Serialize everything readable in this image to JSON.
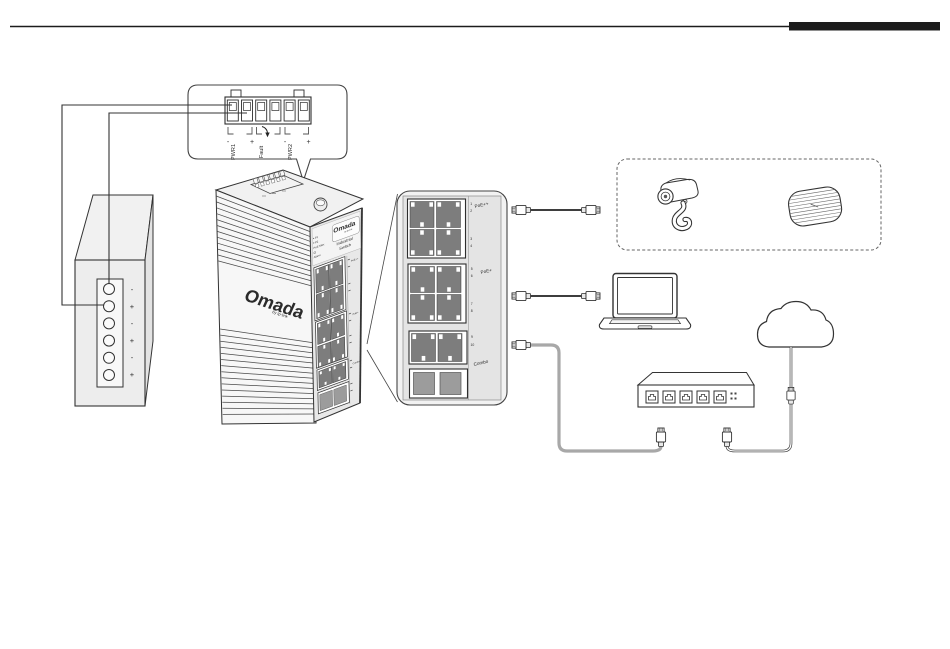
{
  "colors": {
    "line": "#2e2e2e",
    "panel_fill": "#efefef",
    "port_dark": "#7d7d7d",
    "sfp_gray": "#9c9c9c",
    "cable_gray": "#a8a8a8"
  },
  "terminal_callout": {
    "pwr1": "PWR1",
    "fault": "Fault",
    "pwr2": "PWR2",
    "minus": "-",
    "plus": "+"
  },
  "power_supply": {
    "terminals": [
      "-",
      "+",
      "-",
      "+",
      "-",
      "+"
    ]
  },
  "industrial_switch": {
    "side_brand": "Omada",
    "side_brand_sub": "by tp-link",
    "front_brand": "Omada",
    "front_brand_sub": "by tp-link",
    "product_line1": "Industrial",
    "product_line2": "Switch",
    "leds": [
      "P1",
      "P2",
      "PoE Max",
      "Alarm"
    ]
  },
  "port_panel": {
    "groups": [
      {
        "label": "PoE++",
        "numbers": [
          "1",
          "2",
          "3",
          "4"
        ]
      },
      {
        "label": "PoE+",
        "numbers": [
          "5",
          "6",
          "7",
          "8"
        ]
      },
      {
        "label": "Combo",
        "numbers": [
          "9",
          "10"
        ]
      }
    ]
  },
  "icons": {
    "camera": "security-camera",
    "access_point": "wireless-access-point",
    "laptop": "laptop",
    "cloud": "internet-cloud",
    "desktop_switch": "ethernet-switch",
    "plug": "rj45-plug"
  }
}
